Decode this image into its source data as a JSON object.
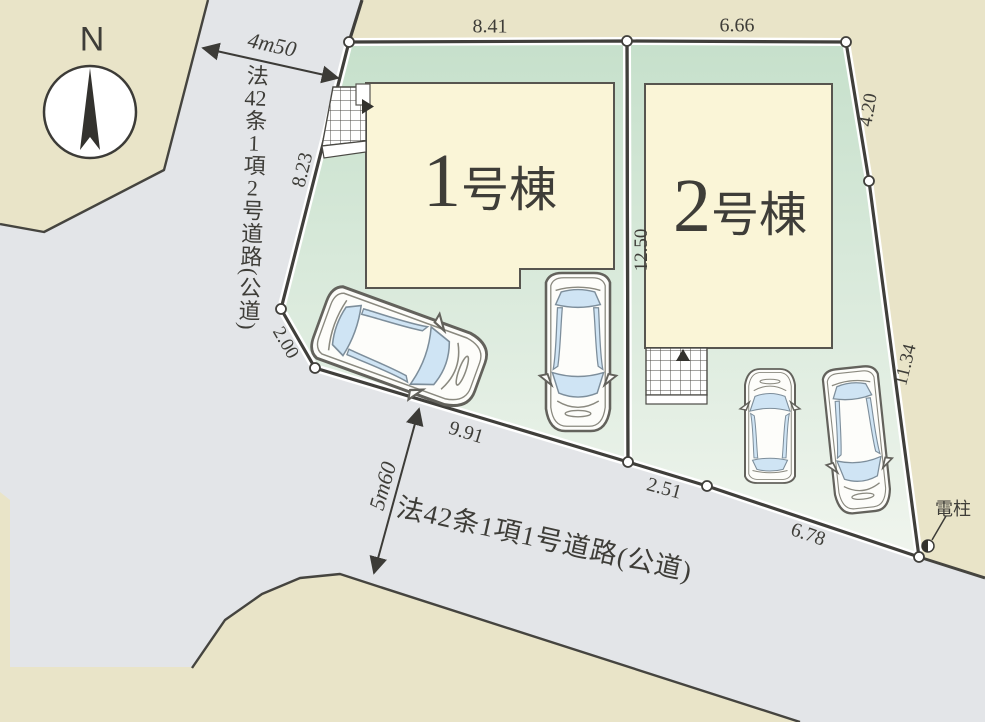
{
  "plan": {
    "compass": {
      "label": "N"
    },
    "lots": {
      "divider_dim": "12.50",
      "lot1": {
        "building": {
          "number": "1",
          "suffix": "号棟"
        },
        "dims": {
          "top": "8.41",
          "left": "8.23",
          "corner": "2.00",
          "bottom": "9.91"
        }
      },
      "lot2": {
        "building": {
          "number": "2",
          "suffix": "号棟"
        },
        "dims": {
          "top": "6.66",
          "right_upper": "4.20",
          "right_lower": "11.34",
          "bottom_left": "2.51",
          "bottom_right": "6.78"
        }
      }
    },
    "roads": {
      "left": {
        "name": "法42条1項2号道路(公道)",
        "name_parts": [
          "法",
          "42",
          "条",
          "1",
          "項",
          "2",
          "号",
          "道",
          "路",
          "(",
          "公",
          "道",
          ")"
        ],
        "width_label": "4m50"
      },
      "bottom": {
        "name": "法42条1項1号道路(公道)",
        "width_label": "5m60"
      }
    },
    "pole": {
      "label": "電柱"
    },
    "colors": {
      "background_beige": "#e9e4c8",
      "road_gray": "#e3e5e8",
      "lot_green_top": "#c8e1cc",
      "lot_green_bottom": "#f0f5ee",
      "building_fill": "#faf5d7",
      "line_dark": "#403f3b",
      "car_glass": "#cfe4f4"
    }
  }
}
